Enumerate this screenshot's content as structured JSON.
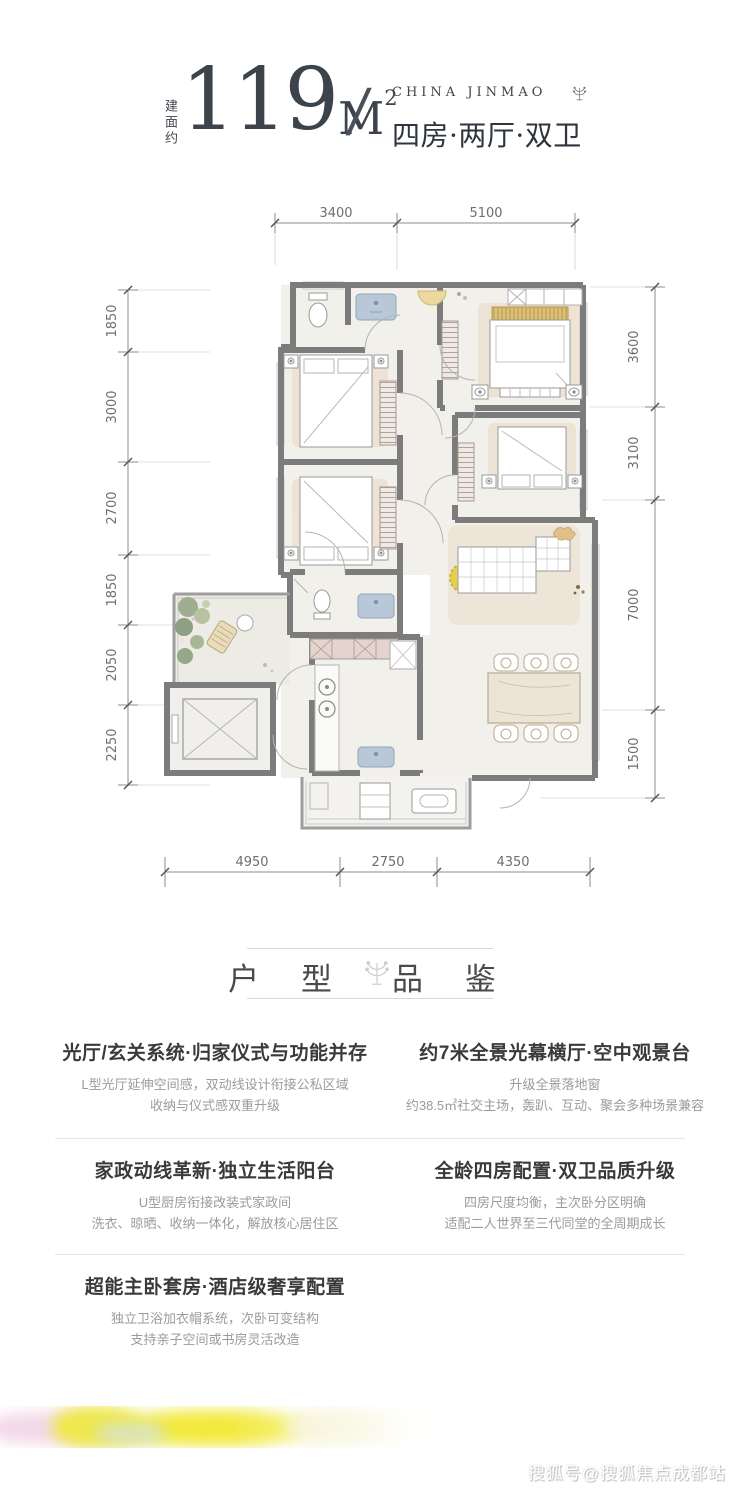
{
  "header": {
    "area_label": "建面约",
    "area_number": "119",
    "area_unit": "M",
    "area_exponent": "2",
    "separator": "/",
    "brand": "CHINA JINMAO",
    "apartment_type": "四房·两厅·双卫"
  },
  "floorplan": {
    "dims_top": [
      "3400",
      "5100"
    ],
    "dims_left": [
      "1850",
      "3000",
      "2700",
      "1850",
      "2050",
      "2250"
    ],
    "dims_right": [
      "3600",
      "3100",
      "7000",
      "1500"
    ],
    "dims_bottom": [
      "4950",
      "2750",
      "4350"
    ]
  },
  "section_title": {
    "left": "户 型",
    "right": "品 鉴"
  },
  "features": [
    {
      "title": "光厅/玄关系统·归家仪式与功能并存",
      "line1": "L型光厅延伸空间感，双动线设计衔接公私区域",
      "line2": "收纳与仪式感双重升级"
    },
    {
      "title": "约7米全景光幕横厅·空中观景台",
      "line1": "升级全景落地窗",
      "line2": "约38.5㎡社交主场，轰趴、互动、聚会多种场景兼容"
    },
    {
      "title": "家政动线革新·独立生活阳台",
      "line1": "U型厨房衔接改装式家政间",
      "line2": "洗衣、晾晒、收纳一体化，解放核心居住区"
    },
    {
      "title": "全龄四房配置·双卫品质升级",
      "line1": "四房尺度均衡，主次卧分区明确",
      "line2": "适配二人世界至三代同堂的全周期成长"
    },
    {
      "title": "超能主卧套房·酒店级奢享配置",
      "line1": "独立卫浴加衣帽系统，次卧可变结构",
      "line2": "支持亲子空间或书房灵活改造"
    }
  ],
  "watermark": "搜狐号@搜狐焦点成都站",
  "colors": {
    "accent_yellow": "#e3cf52",
    "wall_gray": "#7c7c7c",
    "floor_fill": "#f1f0eb",
    "rug_beige": "#ecdfce",
    "title_dark": "#3a3a3a",
    "subtext_gray": "#9b9b9b",
    "dim_gray": "#8c8c8c"
  }
}
